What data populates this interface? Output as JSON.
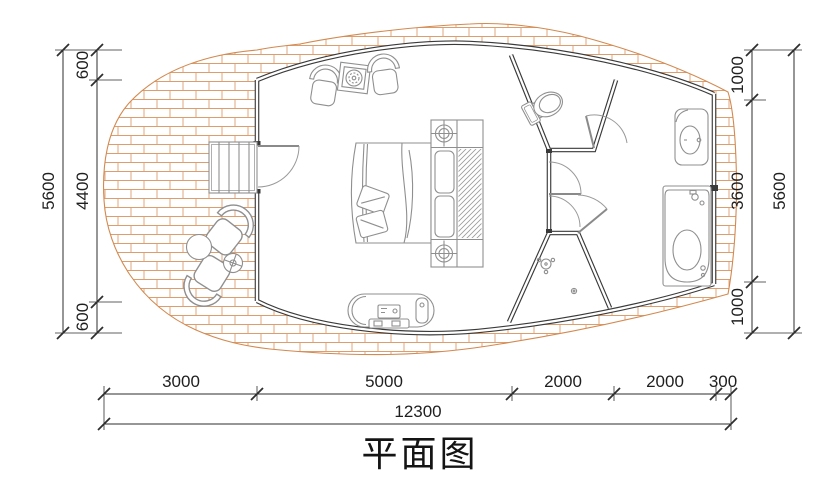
{
  "title": "平面图",
  "colors": {
    "background": "#ffffff",
    "wall": "#3a3a3a",
    "furniture_line": "#8f8f8f",
    "deck_brick": "#dd9e6e",
    "deck_outline": "#d3894f",
    "dimension_line": "#2e2e2e",
    "text": "#1f1f1f"
  },
  "dimensions": {
    "left": {
      "total": "5600",
      "segments": [
        "600",
        "4400",
        "600"
      ]
    },
    "right": {
      "total": "5600",
      "segments": [
        "1000",
        "3600",
        "1000"
      ]
    },
    "bottom": {
      "total": "12300",
      "segments": [
        "3000",
        "5000",
        "2000",
        "2000",
        "300"
      ]
    }
  }
}
